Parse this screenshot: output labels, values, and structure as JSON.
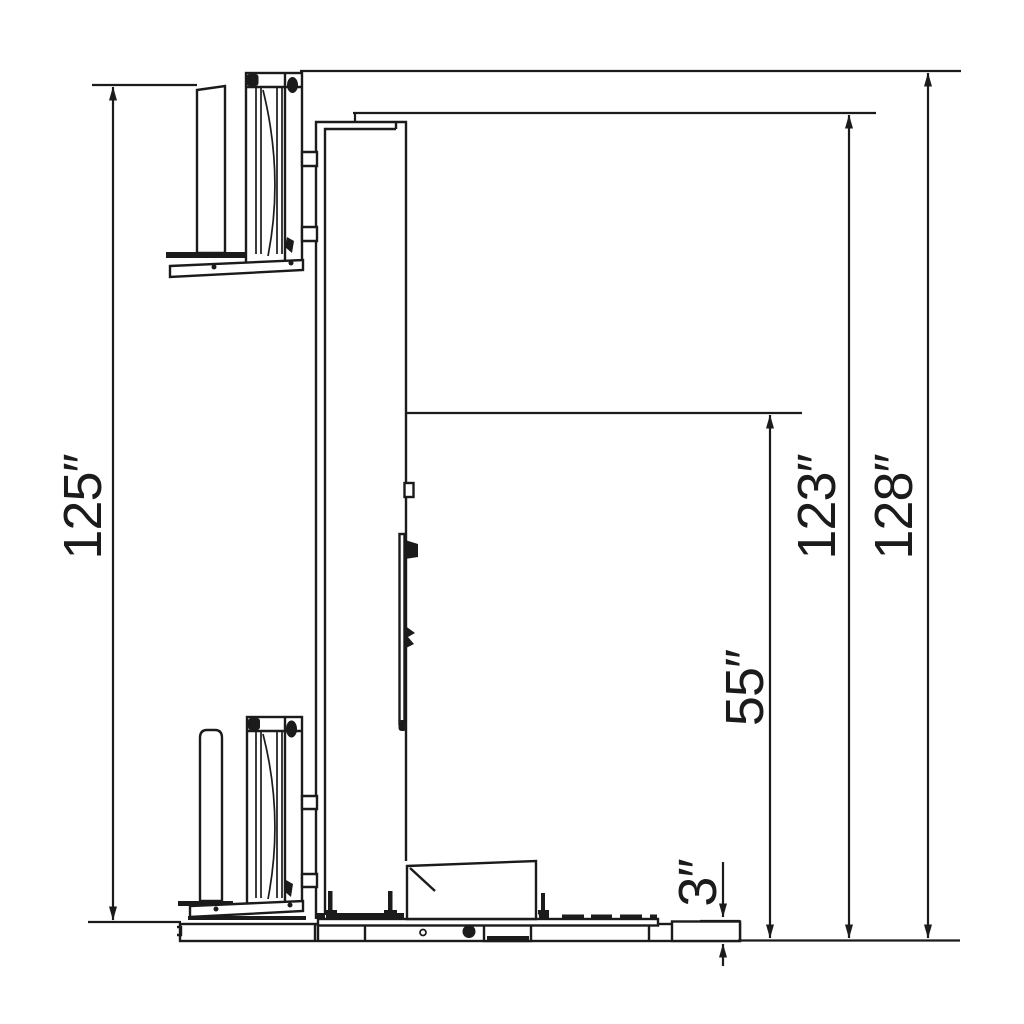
{
  "colors": {
    "ink": "#1b1b1b",
    "background": "#ffffff"
  },
  "dimensions": {
    "overall_height_left": {
      "text": "125″"
    },
    "column_height": {
      "text": "123″"
    },
    "overall_height_right": {
      "text": "128″"
    },
    "carriage_travel": {
      "text": "55″"
    },
    "turntable_height": {
      "text": "3″"
    }
  }
}
